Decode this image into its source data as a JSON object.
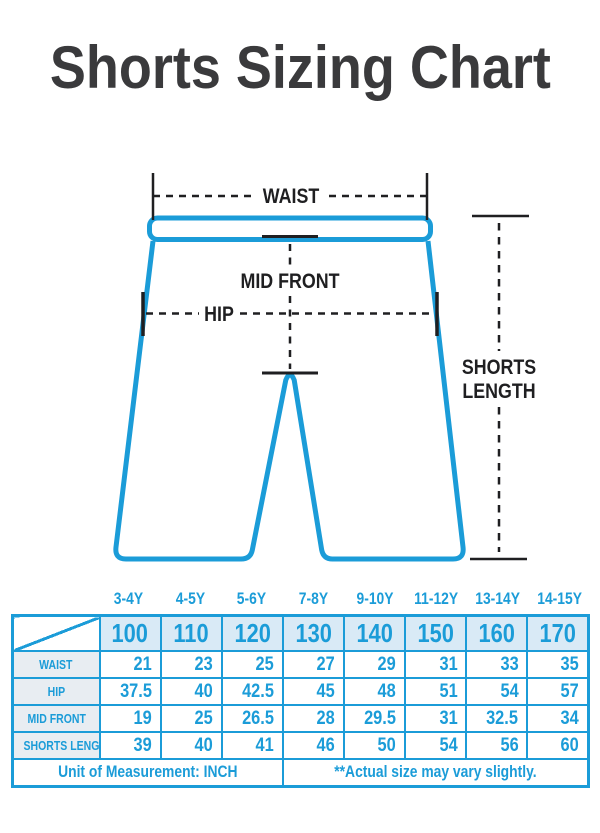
{
  "title": "Shorts Sizing Chart",
  "diagram": {
    "labels": {
      "waist": "WAIST",
      "mid_front": "MID FRONT",
      "hip": "HIP",
      "shorts_length": [
        "SHORTS",
        "LENGTH"
      ]
    },
    "colors": {
      "outline_blue": "#1b9cd8",
      "measurement_black": "#1f1f21"
    }
  },
  "table": {
    "age_headers": [
      "3-4Y",
      "4-5Y",
      "5-6Y",
      "7-8Y",
      "9-10Y",
      "11-12Y",
      "13-14Y",
      "14-15Y"
    ],
    "sizes": [
      "100",
      "110",
      "120",
      "130",
      "140",
      "150",
      "160",
      "170"
    ],
    "rows": [
      {
        "label": "WAIST",
        "values": [
          "21",
          "23",
          "25",
          "27",
          "29",
          "31",
          "33",
          "35"
        ]
      },
      {
        "label": "HIP",
        "values": [
          "37.5",
          "40",
          "42.5",
          "45",
          "48",
          "51",
          "54",
          "57"
        ]
      },
      {
        "label": "MID FRONT",
        "values": [
          "19",
          "25",
          "26.5",
          "28",
          "29.5",
          "31",
          "32.5",
          "34"
        ]
      },
      {
        "label": "SHORTS LENGTH",
        "values": [
          "39",
          "40",
          "41",
          "46",
          "50",
          "54",
          "56",
          "60"
        ]
      }
    ],
    "footer": {
      "left": "Unit of Measurement: INCH",
      "right": "**Actual size may vary slightly."
    },
    "colors": {
      "blue": "#1b9cd8",
      "size_bg": "#d9eaf6",
      "label_bg": "#e8edf2"
    }
  }
}
